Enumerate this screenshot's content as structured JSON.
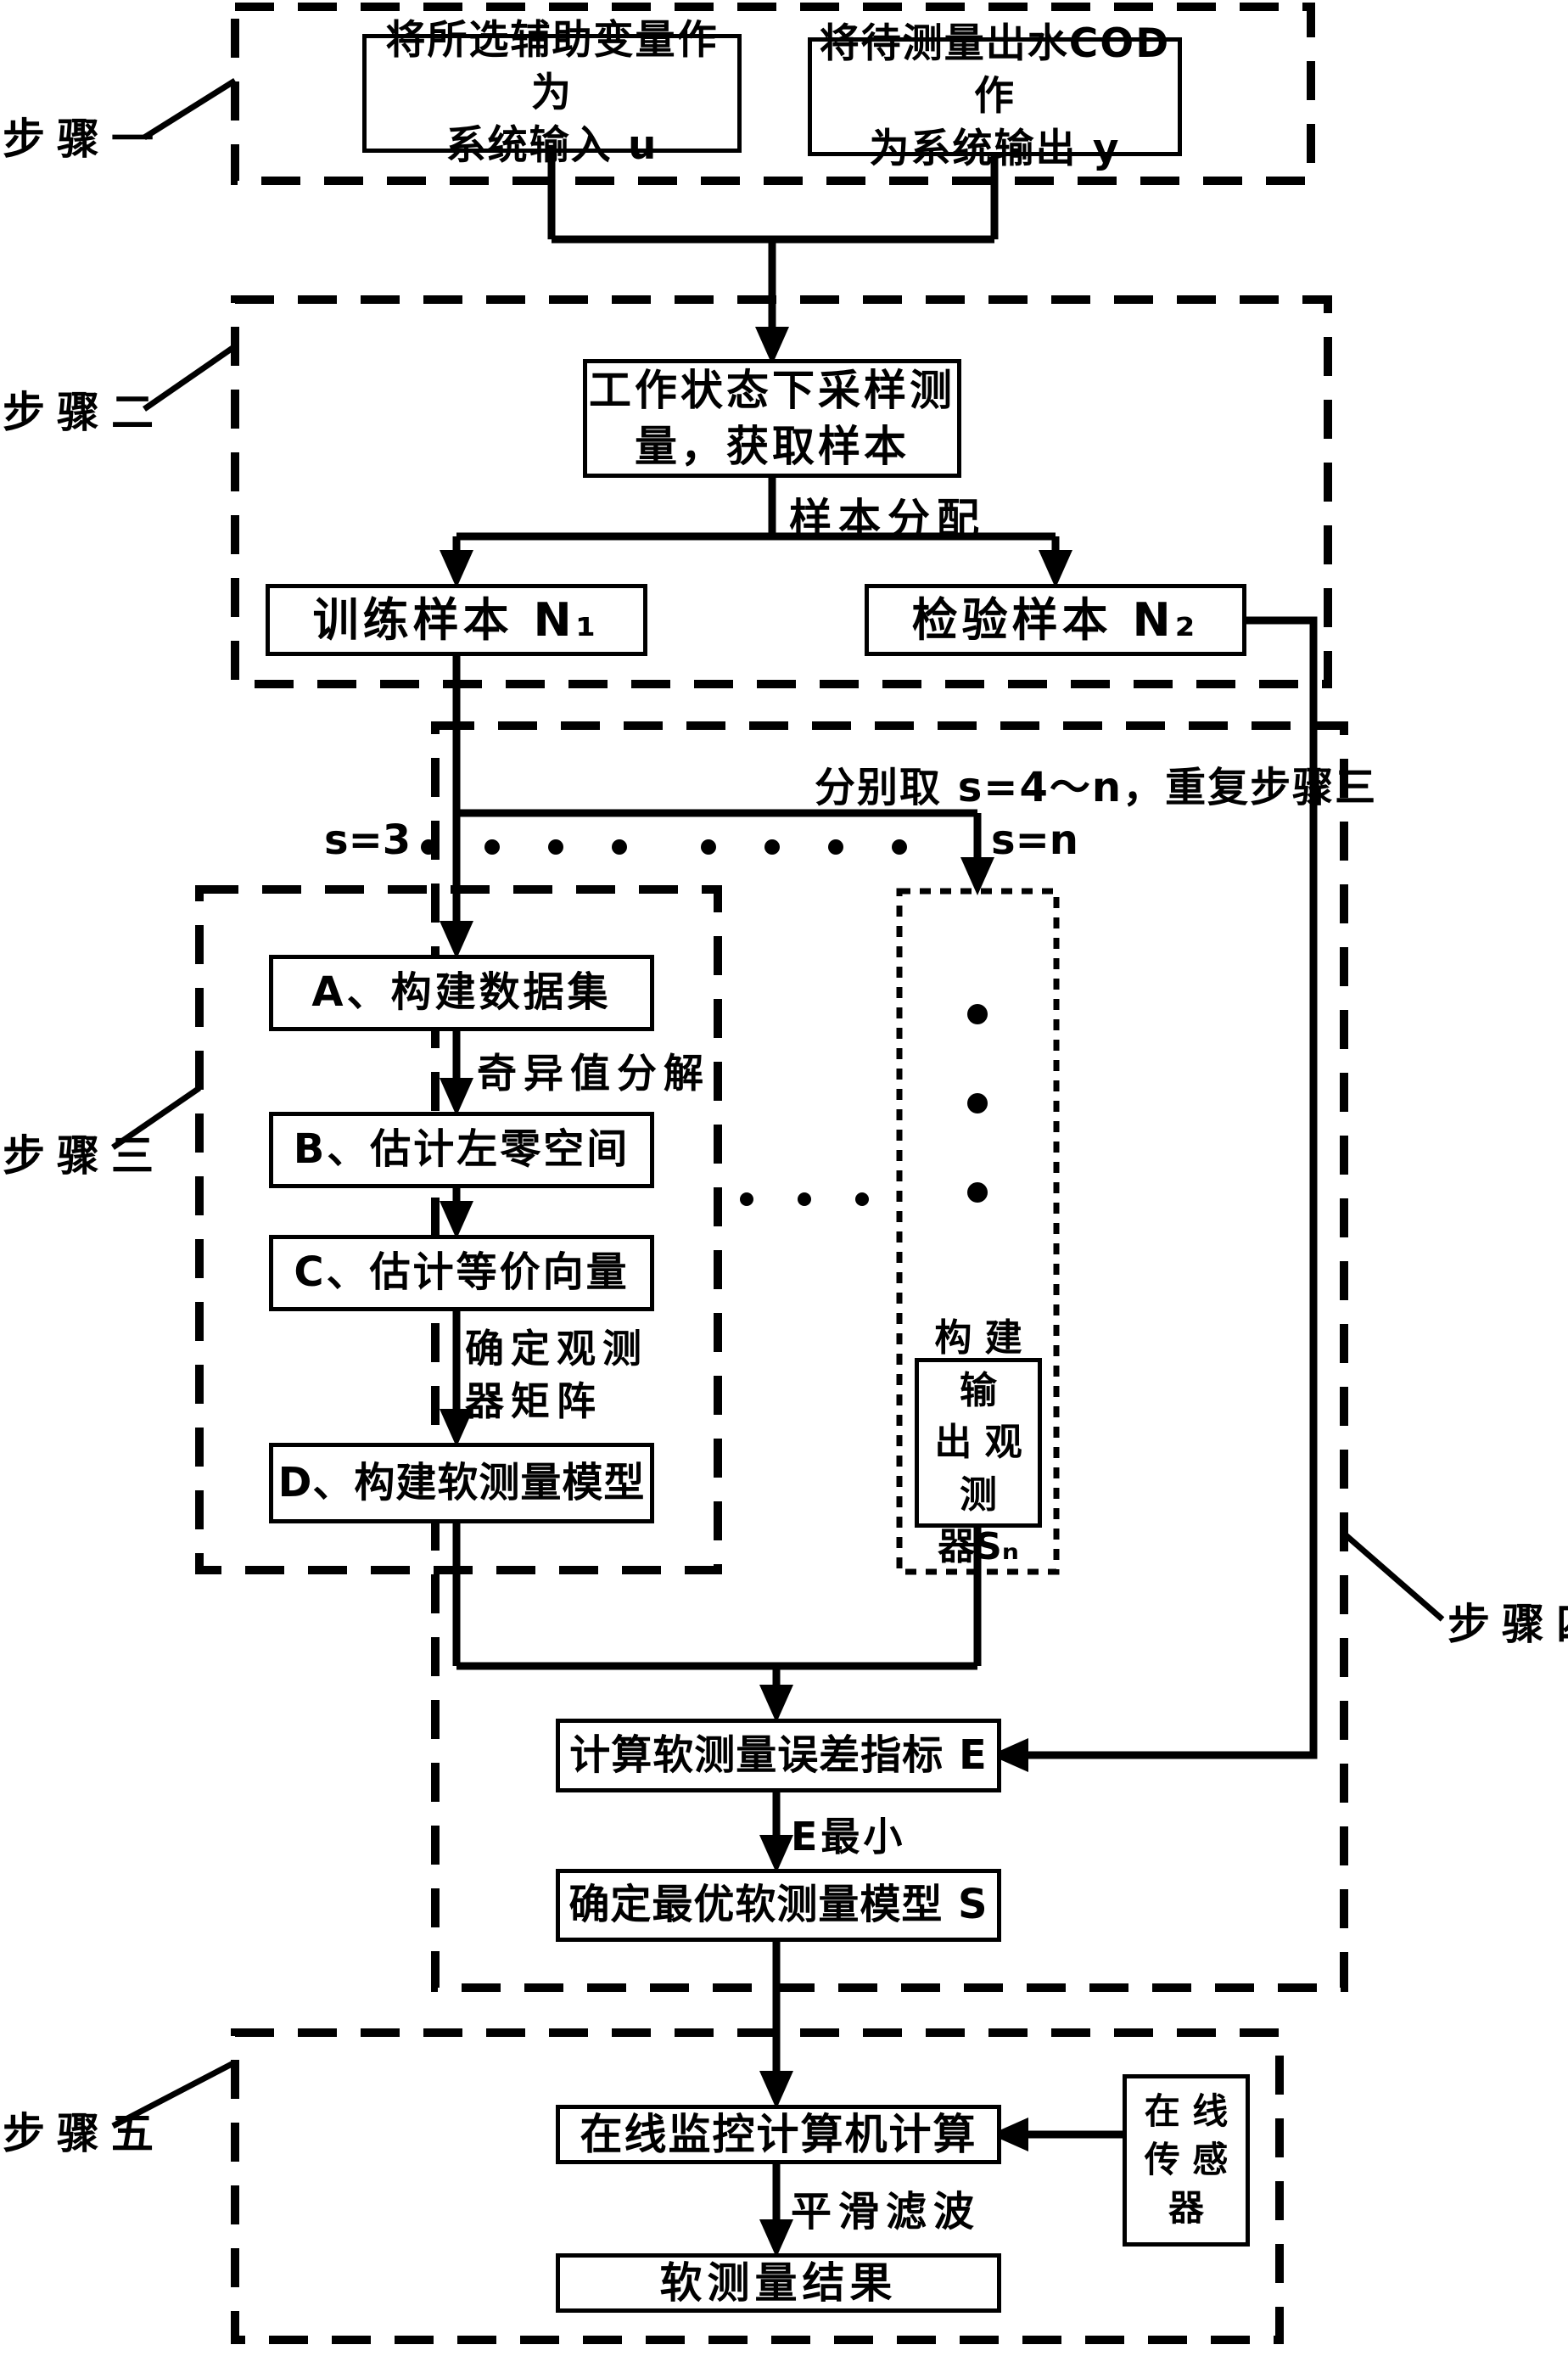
{
  "diagram": {
    "title": "软测量建模流程图",
    "steps": {
      "s1": "步骤一",
      "s2": "步骤二",
      "s3": "步骤三",
      "s4": "步骤四",
      "s5": "步骤五"
    },
    "nodes": {
      "input_box": {
        "line1": "将所选辅助变量作为",
        "line2": "系统输入 u"
      },
      "output_box": {
        "line1": "将待测量出水COD作",
        "line2": "为系统输出 y"
      },
      "sampling_box": {
        "line1": "工作状态下采样测",
        "line2": "量，获取样本"
      },
      "train_box": "训练样本 N₁",
      "test_box": "检验样本 N₂",
      "step_a": "A、构建数据集",
      "step_b": "B、估计左零空间",
      "step_c": "C、估计等价向量",
      "step_d": "D、构建软测量模型",
      "observer_box": {
        "line1": "构 建 输",
        "line2": "出 观 测",
        "line3": "器Sₙ"
      },
      "error_box": "计算软测量误差指标 E",
      "optimal_box": "确定最优软测量模型 S",
      "online_box": "在线监控计算机计算",
      "result_box": "软测量结果",
      "sensor_box": {
        "line1": "在 线",
        "line2": "传 感",
        "line3": "器"
      }
    },
    "edge_labels": {
      "sample_alloc": "样本分配",
      "repeat_note": "分别取 s=4～n，重复步骤三",
      "s3_label": "s=3",
      "sn_label": "s=n",
      "svd": "奇异值分解",
      "observer_matrix_l1": "确定观测",
      "observer_matrix_l2": "器矩阵",
      "e_min": "E最小",
      "smooth": "平滑滤波"
    },
    "colors": {
      "ink": "#000000",
      "paper": "#ffffff"
    }
  }
}
